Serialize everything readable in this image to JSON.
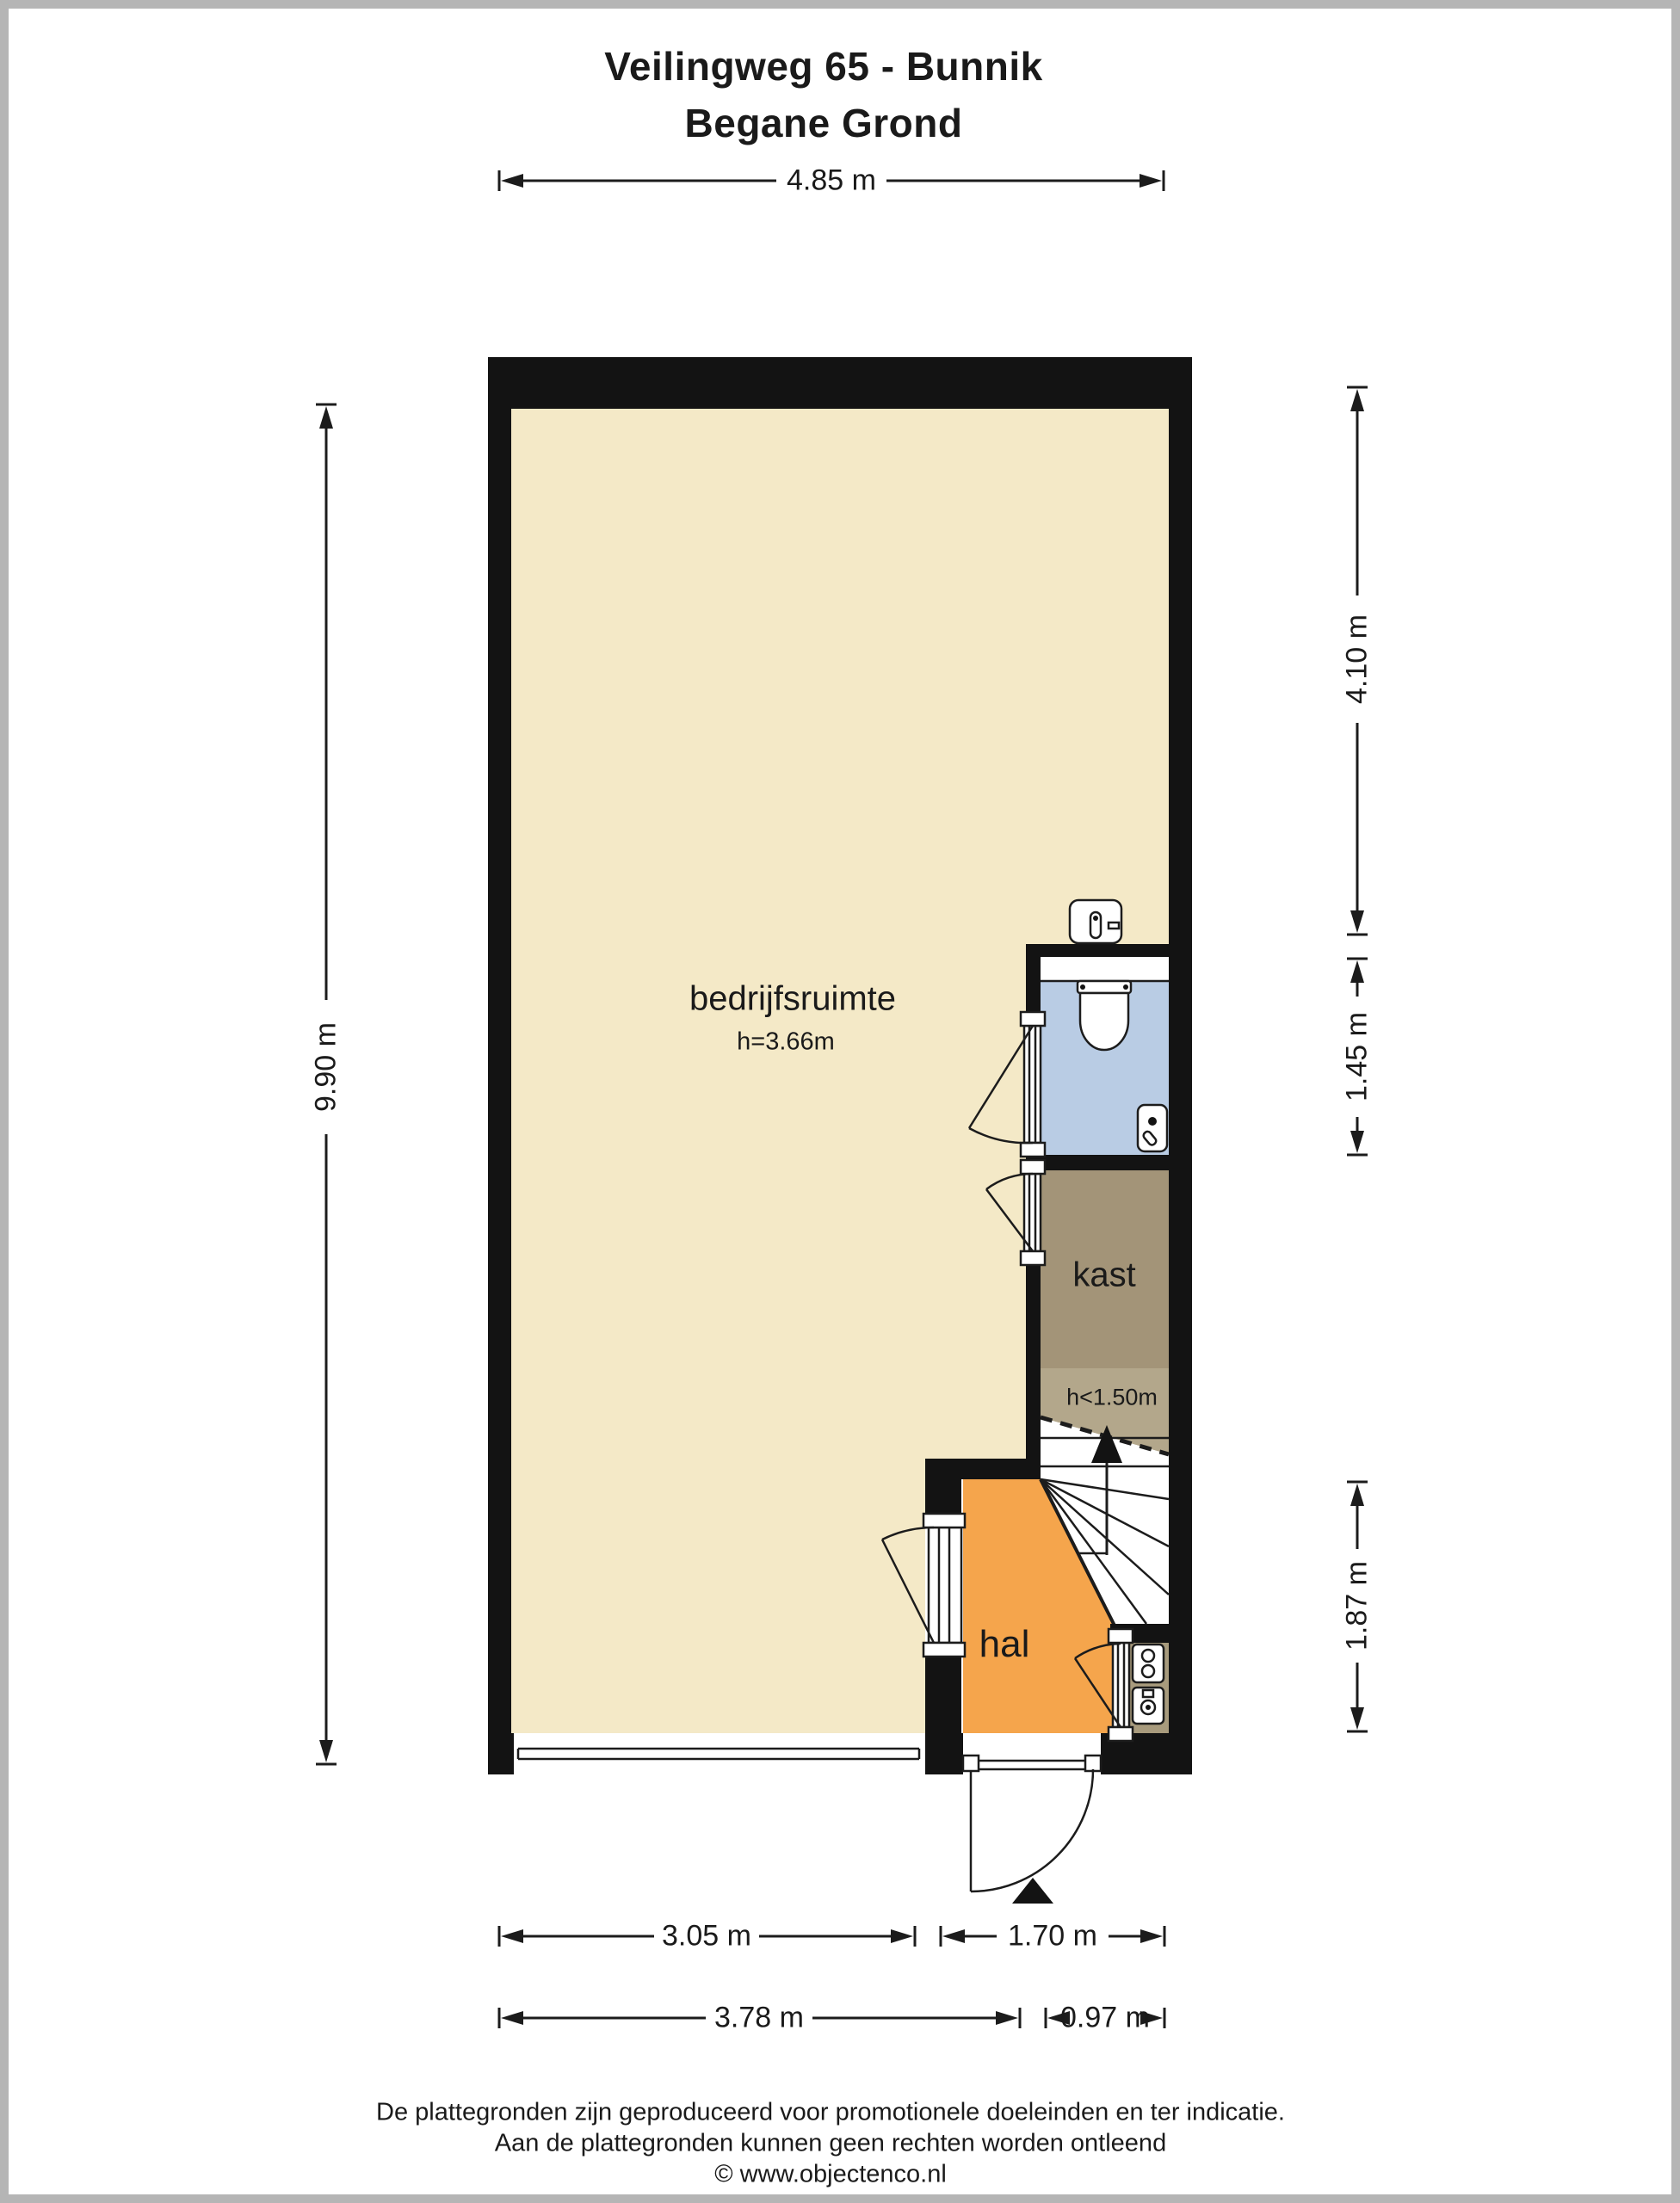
{
  "title": {
    "line1": "Veilingweg 65 - Bunnik",
    "line2": "Begane Grond"
  },
  "rooms": {
    "bedrijfsruimte": {
      "label": "bedrijfsruimte",
      "height_note": "h=3.66m"
    },
    "kast": {
      "label": "kast",
      "height_note": "h<1.50m"
    },
    "hal": {
      "label": "hal"
    }
  },
  "dimensions": {
    "top_width": "4.85 m",
    "left_height": "9.90 m",
    "right_upper": "4.10 m",
    "right_middle": "1.45 m",
    "right_lower": "1.87 m",
    "bottom_row1_left": "3.05 m",
    "bottom_row1_right": "1.70 m",
    "bottom_row2_left": "3.78 m",
    "bottom_row2_right": "0.97 m"
  },
  "footer": {
    "line1": "De plattegronden zijn geproduceerd voor promotionele doeleinden en ter indicatie.",
    "line2": "Aan de plattegronden kunnen geen rechten worden ontleend",
    "line3": "© www.objectenco.nl"
  },
  "colors": {
    "wall": "#131313",
    "floor_main": "#f4e9c7",
    "floor_hal": "#f5a54c",
    "floor_toilet": "#b9cce4",
    "floor_kast": "#a39478",
    "floor_kast_low": "#b3a78b",
    "floor_meterkast": "#a89b7d",
    "frame": "#b5b5b5",
    "line": "#1c1c1c"
  }
}
